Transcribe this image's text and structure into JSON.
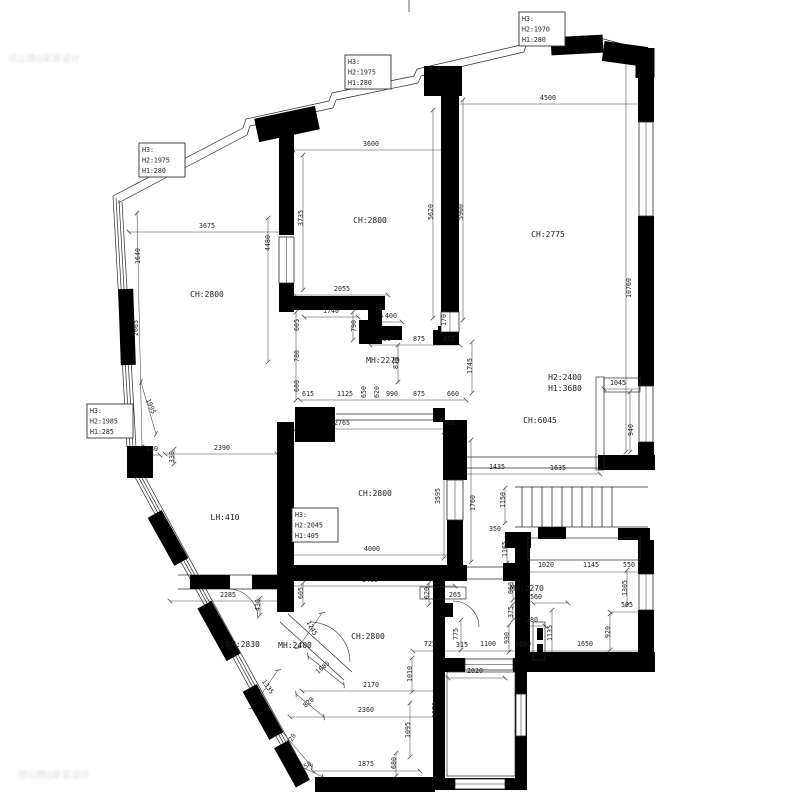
{
  "title": "apartment-floor-plan",
  "colors": {
    "wall": "#000000",
    "line": "#2a2a2a",
    "dim_line": "#444444",
    "text": "#1c1c1c",
    "background": "#ffffff",
    "watermark": "#c3c3c3"
  },
  "watermarks": [
    {
      "x": 8,
      "y": 62,
      "t": "佳山晚@家装设计"
    },
    {
      "x": 18,
      "y": 778,
      "t": "佳山晚@家装设计"
    }
  ],
  "height_boxes": [
    {
      "x": 519,
      "y": 12,
      "lines": [
        "H3:",
        "H2:1970",
        "H1:280"
      ]
    },
    {
      "x": 345,
      "y": 55,
      "lines": [
        "H3:",
        "H2:1975",
        "H1:280"
      ]
    },
    {
      "x": 139,
      "y": 143,
      "lines": [
        "H3:",
        "H2:1975",
        "H1:280"
      ]
    },
    {
      "x": 87,
      "y": 404,
      "lines": [
        "H3:",
        "H2:1985",
        "H1:285"
      ]
    },
    {
      "x": 292,
      "y": 508,
      "lines": [
        "H3:",
        "H2:2045",
        "H1:405"
      ]
    }
  ],
  "room_labels": [
    [
      207,
      297,
      "CH:2800"
    ],
    [
      370,
      223,
      "CH:2800"
    ],
    [
      548,
      237,
      "CH:2775"
    ],
    [
      383,
      363,
      "MH:2270"
    ],
    [
      565,
      380,
      "H2:2400"
    ],
    [
      565,
      391,
      "H1:3680"
    ],
    [
      540,
      423,
      "CH:6045"
    ],
    [
      375,
      496,
      "CH:2800"
    ],
    [
      225,
      520,
      "LH:410"
    ],
    [
      243,
      647,
      "CH:2830"
    ],
    [
      295,
      648,
      "MH:2400"
    ],
    [
      368,
      639,
      "CH:2800"
    ],
    [
      527,
      591,
      "MH:2270"
    ]
  ],
  "dims": [
    [
      548,
      100,
      "4500"
    ],
    [
      371,
      146,
      "3600"
    ],
    [
      207,
      228,
      "3675"
    ],
    [
      140,
      256,
      "1640",
      -90
    ],
    [
      138,
      328,
      "2665",
      -90
    ],
    [
      270,
      243,
      "4480",
      -90
    ],
    [
      303,
      218,
      "3735",
      -90
    ],
    [
      433,
      212,
      "5620",
      -90
    ],
    [
      463,
      212,
      "5900",
      -90
    ],
    [
      631,
      288,
      "10760",
      -90
    ],
    [
      342,
      291,
      "2055"
    ],
    [
      331,
      313,
      "1740"
    ],
    [
      381,
      309,
      "185",
      -90
    ],
    [
      391,
      318,
      "400"
    ],
    [
      356,
      326,
      "790",
      -90
    ],
    [
      299,
      325,
      "605",
      -90
    ],
    [
      299,
      356,
      "780",
      -90
    ],
    [
      299,
      386,
      "600",
      -90
    ],
    [
      385,
      341,
      "630"
    ],
    [
      419,
      341,
      "875"
    ],
    [
      449,
      341,
      "455"
    ],
    [
      446,
      320,
      "170",
      -90
    ],
    [
      398,
      363,
      "875",
      -90
    ],
    [
      472,
      366,
      "1745",
      -90
    ],
    [
      618,
      385,
      "1045"
    ],
    [
      633,
      430,
      "940",
      -90
    ],
    [
      308,
      396,
      "615"
    ],
    [
      345,
      396,
      "1125"
    ],
    [
      366,
      392,
      "650",
      -90
    ],
    [
      379,
      392,
      "620",
      -90
    ],
    [
      392,
      396,
      "990"
    ],
    [
      419,
      396,
      "875"
    ],
    [
      453,
      396,
      "660"
    ],
    [
      342,
      425,
      "2765"
    ],
    [
      449,
      425,
      "360"
    ],
    [
      152,
      451,
      "130"
    ],
    [
      222,
      450,
      "2390"
    ],
    [
      174,
      457,
      "330",
      -90
    ],
    [
      149,
      407,
      "1995",
      68
    ],
    [
      440,
      496,
      "3595",
      -90
    ],
    [
      475,
      503,
      "1760",
      -90
    ],
    [
      497,
      469,
      "1435"
    ],
    [
      558,
      470,
      "1635"
    ],
    [
      505,
      500,
      "1150",
      -90
    ],
    [
      495,
      531,
      "350"
    ],
    [
      507,
      549,
      "1165",
      -90
    ],
    [
      546,
      567,
      "1020"
    ],
    [
      591,
      567,
      "1145"
    ],
    [
      629,
      567,
      "550"
    ],
    [
      513,
      588,
      "860",
      -90
    ],
    [
      536,
      599,
      "560"
    ],
    [
      513,
      612,
      "375",
      -90
    ],
    [
      532,
      622,
      "280"
    ],
    [
      509,
      638,
      "930",
      -90
    ],
    [
      552,
      633,
      "1135",
      -90
    ],
    [
      525,
      646,
      "590"
    ],
    [
      585,
      646,
      "1650"
    ],
    [
      610,
      632,
      "920",
      -90
    ],
    [
      627,
      588,
      "1305",
      -90
    ],
    [
      627,
      607,
      "505"
    ],
    [
      372,
      551,
      "4000"
    ],
    [
      370,
      582,
      "3485"
    ],
    [
      303,
      593,
      "605",
      -90
    ],
    [
      429,
      593,
      "620",
      -90
    ],
    [
      455,
      597,
      "265"
    ],
    [
      228,
      597,
      "2285"
    ],
    [
      260,
      605,
      "430",
      -90
    ],
    [
      310,
      629,
      "1245",
      62
    ],
    [
      324,
      669,
      "1085",
      -40
    ],
    [
      266,
      688,
      "1335",
      55
    ],
    [
      310,
      704,
      "820",
      -40
    ],
    [
      292,
      742,
      "1720",
      -58
    ],
    [
      307,
      768,
      "750",
      -30
    ],
    [
      226,
      646,
      "720",
      55
    ],
    [
      458,
      634,
      "775",
      -90
    ],
    [
      430,
      646,
      "725"
    ],
    [
      462,
      647,
      "315"
    ],
    [
      488,
      646,
      "1100"
    ],
    [
      521,
      647,
      "590"
    ],
    [
      412,
      674,
      "1010",
      -90
    ],
    [
      371,
      687,
      "2170"
    ],
    [
      366,
      712,
      "2360"
    ],
    [
      410,
      730,
      "1095",
      -90
    ],
    [
      437,
      710,
      "1970",
      -90
    ],
    [
      475,
      673,
      "2020"
    ],
    [
      366,
      766,
      "1875"
    ],
    [
      396,
      763,
      "680",
      -90
    ]
  ],
  "diagram": {
    "walls": [
      [
        279,
        132,
        15,
        103
      ],
      [
        279,
        283,
        15,
        29
      ],
      [
        279,
        296,
        106,
        14
      ],
      [
        368,
        310,
        14,
        34
      ],
      [
        441,
        84,
        18,
        228
      ],
      [
        441,
        332,
        18,
        13
      ],
      [
        433,
        330,
        10,
        15
      ],
      [
        359,
        320,
        12,
        24
      ],
      [
        380,
        326,
        22,
        14
      ],
      [
        438,
        326,
        21,
        14
      ],
      [
        295,
        407,
        40,
        35
      ],
      [
        433,
        408,
        12,
        14
      ],
      [
        277,
        422,
        17,
        190
      ],
      [
        443,
        420,
        24,
        60
      ],
      [
        447,
        520,
        16,
        47
      ],
      [
        277,
        565,
        190,
        16
      ],
      [
        503,
        563,
        14,
        18
      ],
      [
        598,
        455,
        57,
        15
      ],
      [
        538,
        527,
        28,
        12
      ],
      [
        618,
        528,
        32,
        12
      ],
      [
        515,
        532,
        15,
        128
      ],
      [
        505,
        532,
        26,
        16
      ],
      [
        515,
        652,
        140,
        20
      ],
      [
        638,
        540,
        16,
        34
      ],
      [
        638,
        610,
        16,
        44
      ],
      [
        638,
        52,
        16,
        70
      ],
      [
        638,
        216,
        16,
        170
      ],
      [
        638,
        442,
        16,
        18
      ],
      [
        315,
        777,
        120,
        15
      ],
      [
        433,
        581,
        12,
        77
      ],
      [
        433,
        658,
        32,
        14
      ],
      [
        513,
        658,
        14,
        14
      ],
      [
        433,
        658,
        12,
        132
      ],
      [
        433,
        778,
        94,
        12
      ],
      [
        515,
        658,
        12,
        132
      ],
      [
        190,
        575,
        40,
        14
      ],
      [
        252,
        575,
        25,
        14
      ],
      [
        537,
        628,
        6,
        12
      ],
      [
        537,
        644,
        6,
        14
      ],
      [
        444,
        603,
        9,
        14
      ]
    ],
    "chunks": [
      [
        287,
        124,
        62,
        24,
        -12
      ],
      [
        443,
        81,
        38,
        30,
        0
      ],
      [
        577,
        45,
        52,
        18,
        -3
      ],
      [
        625,
        54,
        44,
        20,
        8
      ],
      [
        645,
        63,
        19,
        30,
        0
      ],
      [
        127,
        327,
        15,
        76,
        -2
      ],
      [
        140,
        462,
        26,
        32,
        0
      ],
      [
        168,
        538,
        55,
        16,
        61
      ],
      [
        219,
        631,
        60,
        16,
        61
      ],
      [
        263,
        712,
        55,
        16,
        61
      ],
      [
        292,
        764,
        45,
        16,
        61
      ]
    ],
    "windows": [
      [
        639,
        122,
        14,
        94
      ],
      [
        639,
        386,
        14,
        56
      ],
      [
        639,
        574,
        14,
        36
      ],
      [
        279,
        237,
        15,
        46
      ],
      [
        441,
        312,
        18,
        20
      ],
      [
        465,
        659,
        48,
        11
      ],
      [
        455,
        779,
        50,
        10
      ],
      [
        516,
        694,
        10,
        42
      ],
      [
        447,
        480,
        16,
        40
      ]
    ],
    "thinrects": [
      [
        447,
        672,
        68,
        104
      ],
      [
        604,
        378,
        36,
        14
      ],
      [
        596,
        377,
        8,
        93
      ],
      [
        533,
        622,
        12,
        38
      ],
      [
        528,
        538,
        112,
        22
      ],
      [
        420,
        587,
        46,
        12
      ]
    ],
    "lines": [
      [
        113,
        196,
        243,
        128
      ],
      [
        243,
        128,
        246,
        119
      ],
      [
        246,
        119,
        329,
        101
      ],
      [
        329,
        101,
        332,
        93
      ],
      [
        332,
        93,
        414,
        76
      ],
      [
        414,
        76,
        417,
        69
      ],
      [
        417,
        69,
        521,
        45
      ],
      [
        521,
        45,
        523,
        38
      ],
      [
        523,
        38,
        600,
        38
      ],
      [
        600,
        38,
        637,
        48
      ],
      [
        118,
        203,
        247,
        135
      ],
      [
        247,
        135,
        250,
        126
      ],
      [
        250,
        126,
        333,
        108
      ],
      [
        333,
        108,
        336,
        100
      ],
      [
        336,
        100,
        418,
        83
      ],
      [
        418,
        83,
        421,
        76
      ],
      [
        421,
        76,
        524,
        52
      ],
      [
        524,
        52,
        526,
        45
      ],
      [
        526,
        45,
        601,
        45
      ],
      [
        601,
        45,
        637,
        55
      ],
      [
        113,
        196,
        127,
        447
      ],
      [
        116,
        198,
        130,
        447
      ],
      [
        119,
        200,
        133,
        447
      ],
      [
        122,
        202,
        136,
        447
      ],
      [
        131,
        470,
        230,
        652
      ],
      [
        134,
        469,
        233,
        651
      ],
      [
        136,
        467,
        235,
        649
      ],
      [
        139,
        466,
        238,
        648
      ],
      [
        230,
        652,
        300,
        780
      ],
      [
        233,
        651,
        303,
        779
      ],
      [
        235,
        649,
        305,
        777
      ],
      [
        238,
        648,
        308,
        776
      ],
      [
        178,
        575,
        277,
        575
      ],
      [
        178,
        589,
        277,
        589
      ],
      [
        336,
        414,
        443,
        414
      ],
      [
        336,
        420,
        443,
        420
      ],
      [
        467,
        567,
        515,
        567
      ],
      [
        467,
        579,
        515,
        579
      ],
      [
        462,
        457,
        598,
        457
      ],
      [
        462,
        468,
        598,
        468
      ],
      [
        515,
        487,
        648,
        487
      ],
      [
        515,
        527,
        648,
        527
      ],
      [
        288,
        614,
        352,
        672
      ],
      [
        280,
        622,
        344,
        680
      ],
      [
        409,
        0,
        409,
        12
      ]
    ],
    "dlines": [
      [
        448,
        104,
        648,
        104
      ],
      [
        293,
        150,
        450,
        150
      ],
      [
        129,
        232,
        285,
        232
      ],
      [
        137,
        213,
        142,
        447
      ],
      [
        268,
        218,
        268,
        362
      ],
      [
        303,
        155,
        303,
        290
      ],
      [
        433,
        110,
        433,
        318
      ],
      [
        463,
        100,
        463,
        320
      ],
      [
        626,
        58,
        626,
        452
      ],
      [
        295,
        295,
        388,
        295
      ],
      [
        304,
        317,
        358,
        317
      ],
      [
        381,
        300,
        381,
        318
      ],
      [
        380,
        322,
        402,
        322
      ],
      [
        353,
        312,
        353,
        340
      ],
      [
        296,
        312,
        296,
        400
      ],
      [
        370,
        345,
        460,
        345
      ],
      [
        398,
        345,
        398,
        382
      ],
      [
        300,
        400,
        466,
        400
      ],
      [
        472,
        342,
        472,
        393
      ],
      [
        604,
        389,
        648,
        389
      ],
      [
        630,
        392,
        630,
        452
      ],
      [
        293,
        429,
        460,
        429
      ],
      [
        444,
        432,
        444,
        558
      ],
      [
        471,
        440,
        471,
        562
      ],
      [
        460,
        474,
        600,
        474
      ],
      [
        505,
        488,
        505,
        523
      ],
      [
        507,
        535,
        507,
        563
      ],
      [
        520,
        572,
        648,
        572
      ],
      [
        513,
        576,
        513,
        600
      ],
      [
        533,
        603,
        568,
        603
      ],
      [
        513,
        604,
        513,
        620
      ],
      [
        520,
        626,
        545,
        626
      ],
      [
        509,
        625,
        509,
        652
      ],
      [
        552,
        610,
        552,
        655
      ],
      [
        413,
        651,
        648,
        651
      ],
      [
        610,
        614,
        610,
        650
      ],
      [
        610,
        612,
        648,
        612
      ],
      [
        627,
        570,
        627,
        605
      ],
      [
        285,
        555,
        460,
        555
      ],
      [
        285,
        586,
        455,
        586
      ],
      [
        303,
        583,
        303,
        605
      ],
      [
        429,
        583,
        429,
        605
      ],
      [
        170,
        601,
        285,
        601
      ],
      [
        260,
        598,
        260,
        615
      ],
      [
        165,
        454,
        277,
        454
      ],
      [
        174,
        449,
        174,
        464
      ],
      [
        146,
        455,
        160,
        455
      ],
      [
        302,
        691,
        440,
        691
      ],
      [
        290,
        717,
        440,
        717
      ],
      [
        313,
        771,
        420,
        771
      ],
      [
        448,
        678,
        505,
        678
      ],
      [
        441,
        662,
        441,
        758
      ],
      [
        412,
        658,
        412,
        692
      ],
      [
        410,
        703,
        410,
        757
      ],
      [
        396,
        753,
        396,
        776
      ],
      [
        461,
        620,
        461,
        650
      ],
      [
        141,
        382,
        156,
        434
      ],
      [
        298,
        648,
        322,
        613
      ],
      [
        308,
        656,
        344,
        685
      ],
      [
        252,
        708,
        278,
        670
      ],
      [
        296,
        694,
        324,
        717
      ],
      [
        273,
        721,
        312,
        767
      ],
      [
        293,
        763,
        323,
        777
      ]
    ],
    "stairs": {
      "x": 522,
      "yTop": 487,
      "yBot": 527,
      "n": 10,
      "step": 10
    },
    "arcs": [
      "M 228,589 A 30 30 0 0 1 258,619",
      "M 310,622 A 40 40 0 0 1 350,662",
      "M 453,601 A 26 26 0 0 1 479,627"
    ]
  }
}
